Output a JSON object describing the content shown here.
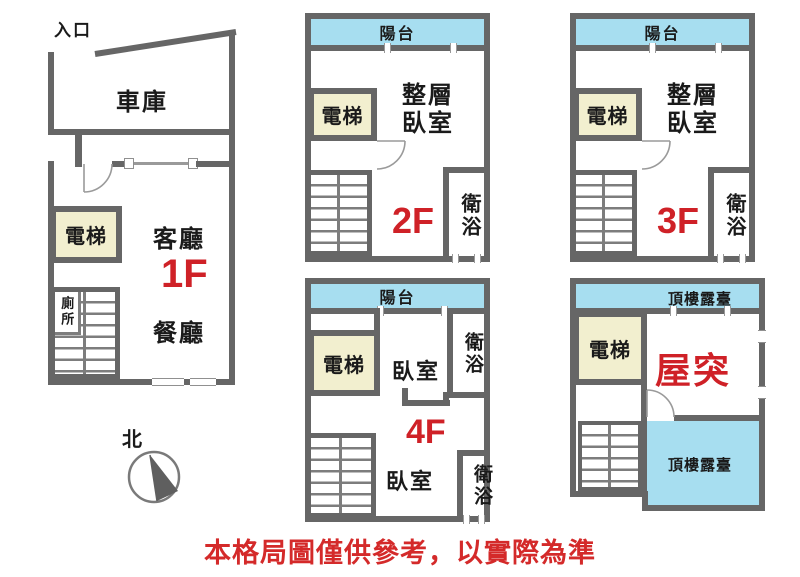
{
  "colors": {
    "wall": "#666666",
    "stair": "#7d7d7d",
    "balcony": "#a7def0",
    "elevator": "#f2efcf",
    "red": "#cf2127",
    "disc": "#d42a2a",
    "arc": "#9a9a9a",
    "txt": "#1a1a1a"
  },
  "disclaimer": "本格局圖僅供參考，以實際為準",
  "compass": {
    "north_label": "北"
  },
  "f1": {
    "entrance": "入口",
    "garage": "車庫",
    "elevator": "電梯",
    "living": "客廳",
    "floor_label": "1F",
    "dining": "餐廳",
    "toilet": "廁所"
  },
  "f2": {
    "balcony": "陽台",
    "elevator": "電梯",
    "bedroom_line1": "整層",
    "bedroom_line2": "臥室",
    "floor_label": "2F",
    "bath": "衛浴"
  },
  "f3": {
    "balcony": "陽台",
    "elevator": "電梯",
    "bedroom_line1": "整層",
    "bedroom_line2": "臥室",
    "floor_label": "3F",
    "bath": "衛浴"
  },
  "f4": {
    "balcony": "陽台",
    "elevator": "電梯",
    "bedroom_upper": "臥室",
    "bath_upper": "衛浴",
    "floor_label": "4F",
    "bedroom_lower": "臥室",
    "bath_lower": "衛浴"
  },
  "roof": {
    "terrace_label_top": "頂樓露臺",
    "elevator": "電梯",
    "penthouse_label": "屋突",
    "terrace_label_bottom": "頂樓露臺"
  }
}
